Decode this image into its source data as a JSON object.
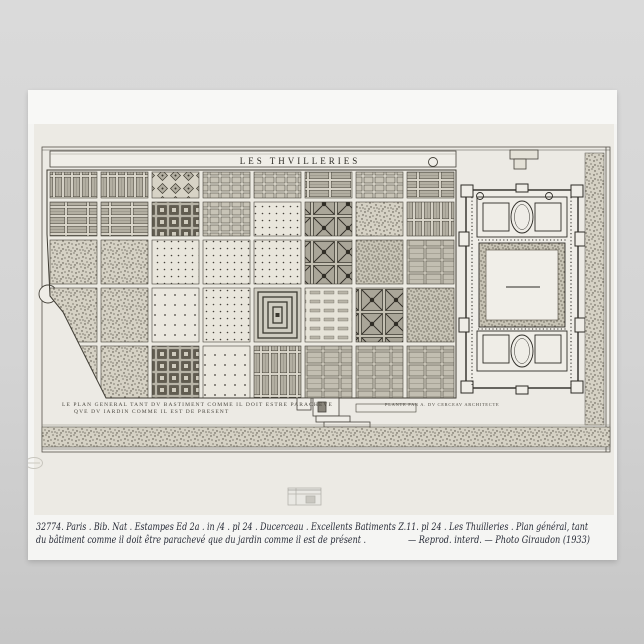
{
  "scene": {
    "background_top": "#dadada",
    "background_bottom": "#c6c6c6"
  },
  "poster": {
    "paper_color": "#f5f5f3",
    "plate_color": "#eceae4",
    "ink_color": "#3a372f",
    "plate": {
      "title": "LES THVILLERIES",
      "caption_left_line1": "LE PLAN GENERAL TANT DV BASTIMENT COMME IL DOIT ESTRE PARACHEVE",
      "caption_left_line2": "QVE DV IARDIN COMME IL EST DE PRESENT",
      "caption_right": "PLANTE PAR A. DV CERCEAV ARCHITECTE"
    },
    "note": {
      "ink_color": "#262a36",
      "line1": "32774. Paris . Bib. Nat . Estampes Ed 2a . in /4 . pl 24 . Ducerceau . Excellents Batiments Z.11. pl 24 . Les Thuilleries . Plan général, tant",
      "line2a": "du bâtiment comme il doit être parachevé que du jardin comme il est de présent .",
      "line2b": "— Reprod. interd. — Photo Giraudon (1933)"
    }
  },
  "plan": {
    "garden": {
      "rows": [
        [
          "vbeds",
          "vbeds",
          "fancy",
          "cells",
          "cells",
          "hbeds",
          "cells",
          "hbeds"
        ],
        [
          "hbeds",
          "hbeds",
          "knot",
          "cells",
          "dots",
          "knotx",
          "stipple",
          "vbeds"
        ],
        [
          "stipple",
          "stipple",
          "dots",
          "dots",
          "dots",
          "knotx",
          "stipple2",
          "gridbeds"
        ],
        [
          "stipple",
          "stipple",
          "dots2",
          "dots",
          "labyrinth",
          "nursery",
          "knotx",
          "stipple2"
        ],
        [
          "stipple",
          "stipple",
          "knot",
          "dots2",
          "vbeds",
          "gridbeds",
          "gridbeds",
          "gridbeds"
        ]
      ]
    }
  }
}
